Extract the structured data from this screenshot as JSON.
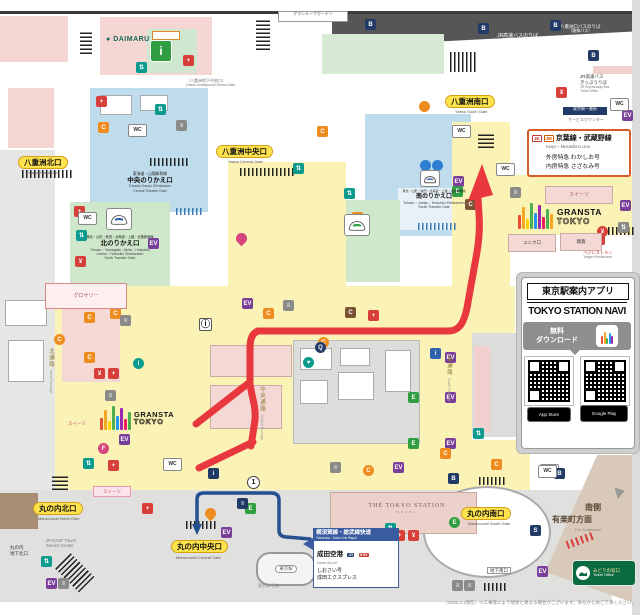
{
  "palette": {
    "route_red": "#e8383d",
    "route_navy": "#24508f",
    "concourse_yellow": "#fbf2b6",
    "shinkansen_blue": "#bedcec",
    "transfer_green": "#cfe7cb",
    "shop_pink": "#f5d6d2",
    "gray_zone": "#dcdcda",
    "dark_wall": "#565656",
    "pill_yellow": "#ffe34d",
    "keiyo_border": "#d85b2a"
  },
  "top": {
    "granroof": "グランルーフガーデン",
    "daimaru": "DAIMARU",
    "jr_bus_jp": "JR高速バスのりば",
    "jr_bus_en": "JR Expressway Bus Terminal",
    "yaesu_bus_jp": "八重洲口バスのりば",
    "yaesu_bus_sub": "（路線バス）",
    "bus_ticket_jp1": "JR高速バス",
    "bus_ticket_jp2": "きっぷうりば",
    "bus_ticket_en1": "JR Expressway Bus",
    "bus_ticket_en2": "Ticket Office",
    "ichibangai": "東京駅一番街",
    "service_counter": "サービスカウンター"
  },
  "gates": {
    "yaesu_north": {
      "jp": "八重洲北口",
      "en": "Yaesu North Gate"
    },
    "yaesu_central": {
      "jp": "八重洲中央口",
      "en": "Yaesu Central Gate"
    },
    "yaesu_south": {
      "jp": "八重洲南口",
      "en": "Yaesu South Gate"
    },
    "marunouchi_north": {
      "jp": "丸の内北口",
      "en": "Marunouchi North Gate"
    },
    "marunouchi_central": {
      "jp": "丸の内中央口",
      "en": "Marunouchi Central Gate"
    },
    "marunouchi_south": {
      "jp": "丸の内南口",
      "en": "Marunouchi South Gate"
    },
    "chika_north1": "丸の内",
    "chika_north2": "地下北口",
    "chika_south": "地下南口",
    "yaesu_chika": "（八重洲地下中央口）",
    "yaesu_chika_en": "(Yaesu Underground Central Gate)"
  },
  "transfer": {
    "central": {
      "lines": "東海道・山陽新幹線",
      "gate": "中央のりかえ口",
      "en1": "Tokaido-Sanyo Shinkansen",
      "en2": "Central Transfer Gate"
    },
    "north": {
      "lines": "東北・山形・秋田・北海道・上越・北陸新幹線",
      "gate": "北のりかえ口",
      "en1": "Tohoku・Yamagata・Akita・Hokkaido",
      "en2": "Joetsu・Hokuriku Shinkansen",
      "en3": "North Transfer Gate"
    },
    "south": {
      "lines": "東北・山形・秋田・北海道・上越・北陸新幹線",
      "gate": "南のりかえ口",
      "en1": "Tohoku・Joetsu・Hokuriku Shinkansen",
      "en2": "South Transfer Gate"
    }
  },
  "keiyo": {
    "badge1": "JE",
    "badge2": "JM",
    "title": "京葉線・武蔵野線",
    "en": "Keiyo・Musashino Line",
    "line1": "外房特急 わかしお号",
    "line2": "内房特急 さざなみ号"
  },
  "gransta": {
    "name": "GRANSTA",
    "sub": "TOKYO"
  },
  "shops": {
    "grocery": "グロサリー",
    "sweets": "スイーツ",
    "sweets2": "スイーツ",
    "sweets3": "スイーツ",
    "uniqlo": "ユニクロ",
    "zakka": "雑貨",
    "veg1": "ベジレストラン",
    "veg2": "Vegan Restaurant"
  },
  "app": {
    "title": "東京駅案内アプリ",
    "name": "TOKYO STATION NAVI",
    "free": "無料",
    "download": "ダウンロード",
    "store1": "App Store",
    "store2": "Google Play"
  },
  "marunouchi": {
    "travel1": "JR EAST Travel",
    "travel2": "Service Center",
    "station": "東京駅",
    "station_sub": "東京駅 石像",
    "hotel": "THE TOKYO STATION",
    "hotel_sub": "HOTEL",
    "yokosuka": {
      "title": "横須賀線・総武線快速",
      "en": "Yokosuka・Sobu Line Rapid",
      "dest": "成田空港",
      "dest_en": "Narita Airport",
      "t1": "しおさい号",
      "t2": "成田エクスプレス",
      "badge1": "JO",
      "badge2": "N'EX"
    },
    "south_side1": "南側",
    "south_side2": "有楽町方面",
    "south_side_en": "For Yurakucho",
    "midori1": "みどりの窓口",
    "midori2": "Ticket Office"
  },
  "passages": {
    "north": "北通路",
    "north_en": "North Passage",
    "central": "中央通路",
    "central_en": "Central Passage",
    "south": "南通路",
    "south_en": "South Passage"
  },
  "footer": "（2025.3.1現在）※工事等により現状と異なる場合がございます。あらかじめご了承ください。",
  "chips": [
    [
      "sq",
      136,
      62,
      "#0a9b8e",
      "⇅",
      "escalator-icon"
    ],
    [
      "sq",
      183,
      55,
      "#d7403a",
      "+",
      "first-aid-icon"
    ],
    [
      "sq",
      365,
      19,
      "#223a66",
      "B",
      "bus-stop-icon"
    ],
    [
      "sq",
      478,
      23,
      "#223a66",
      "B",
      "bus-stop-icon"
    ],
    [
      "sq",
      550,
      20,
      "#223a66",
      "B",
      "bus-stop-icon"
    ],
    [
      "sq",
      588,
      50,
      "#223a66",
      "B",
      "bus-stop-icon"
    ],
    [
      "sq",
      556,
      87,
      "#d7403a",
      "¥",
      "ticket-machine-icon"
    ],
    [
      "sq",
      622,
      110,
      "#7a3f98",
      "EV",
      "elevator-icon"
    ],
    [
      "wc",
      610,
      98,
      "",
      "WC",
      "restroom-icon"
    ],
    [
      "sq",
      96,
      96,
      "#d7403a",
      "+",
      "first-aid-icon"
    ],
    [
      "sq",
      98,
      122,
      "#ef8c1f",
      "C",
      "coin-locker-icon"
    ],
    [
      "wc",
      128,
      124,
      "",
      "WC",
      "restroom-icon"
    ],
    [
      "sq",
      155,
      104,
      "#0a9b8e",
      "⇅",
      "escalator-icon"
    ],
    [
      "sq",
      176,
      120,
      "#8a8a88",
      "≡",
      "stairs-icon"
    ],
    [
      "info",
      199,
      318,
      "",
      "ⓘ",
      "information-icon"
    ],
    [
      "sq",
      242,
      298,
      "#7a3f98",
      "EV",
      "elevator-icon"
    ],
    [
      "sq",
      74,
      206,
      "#d7403a",
      "+",
      "first-aid-icon"
    ],
    [
      "wc",
      78,
      212,
      "",
      "WC",
      "restroom-icon"
    ],
    [
      "sq",
      148,
      238,
      "#7a3f98",
      "EV",
      "elevator-icon"
    ],
    [
      "sq",
      75,
      256,
      "#d7403a",
      "¥",
      "ticket-machine-icon"
    ],
    [
      "sq",
      76,
      230,
      "#0a9b8e",
      "⇅",
      "escalator-icon"
    ],
    [
      "sq",
      293,
      163,
      "#0a9b8e",
      "⇅",
      "escalator-icon"
    ],
    [
      "sq",
      317,
      126,
      "#ef8c1f",
      "C",
      "coin-locker-icon"
    ],
    [
      "ci",
      419,
      101,
      "#ef8c1f",
      "",
      "meeting-point-icon"
    ],
    [
      "wc",
      452,
      125,
      "",
      "WC",
      "restroom-icon"
    ],
    [
      "sq",
      453,
      176,
      "#7a3f98",
      "EV",
      "elevator-icon"
    ],
    [
      "sq",
      344,
      188,
      "#0a9b8e",
      "⇅",
      "escalator-icon"
    ],
    [
      "sq",
      352,
      212,
      "#ef8c1f",
      "C",
      "coin-locker-icon"
    ],
    [
      "wc",
      496,
      163,
      "",
      "WC",
      "restroom-icon"
    ],
    [
      "sq",
      465,
      199,
      "#7b5335",
      "C",
      "coin-locker-icon"
    ],
    [
      "sq",
      452,
      186,
      "#2f9e41",
      "E",
      "exit-icon"
    ],
    [
      "sq",
      533,
      152,
      "#d7403a",
      "+",
      "first-aid-icon"
    ],
    [
      "sq",
      594,
      234,
      "#d7403a",
      "¥",
      "ticket-machine-icon"
    ],
    [
      "sq",
      618,
      222,
      "#8a8a88",
      "⇅",
      "escalator-icon"
    ],
    [
      "sq",
      620,
      200,
      "#7a3f98",
      "EV",
      "elevator-icon"
    ],
    [
      "ci",
      597,
      226,
      "#d7403a",
      "¥",
      "atm-icon"
    ],
    [
      "sq",
      263,
      308,
      "#ef8c1f",
      "C",
      "coin-locker-icon"
    ],
    [
      "sq",
      283,
      300,
      "#8a8a88",
      "≡",
      "stairs-icon"
    ],
    [
      "sq",
      345,
      307,
      "#7b5335",
      "C",
      "coin-locker-icon"
    ],
    [
      "sq",
      368,
      310,
      "#d7403a",
      "+",
      "first-aid-icon"
    ],
    [
      "ci",
      318,
      337,
      "#ef8c1f",
      "C",
      "coin-locker-icon"
    ],
    [
      "ci",
      303,
      357,
      "#0a9b8e",
      "♥",
      "meeting-point-icon"
    ],
    [
      "ci",
      315,
      342,
      "#223a66",
      "Q",
      "info-search-icon"
    ],
    [
      "ci",
      133,
      358,
      "#0a9b8e",
      "i",
      "information-icon"
    ],
    [
      "sq",
      84,
      312,
      "#ef8c1f",
      "C",
      "coin-locker-icon"
    ],
    [
      "sq",
      110,
      308,
      "#ef8c1f",
      "C",
      "coin-locker-icon"
    ],
    [
      "sq",
      84,
      352,
      "#ef8c1f",
      "C",
      "coin-locker-icon"
    ],
    [
      "ci",
      54,
      334,
      "#ef8c1f",
      "C",
      "coin-locker-icon"
    ],
    [
      "sq",
      94,
      368,
      "#d7403a",
      "¥",
      "ticket-machine-icon"
    ],
    [
      "sq",
      108,
      368,
      "#d7403a",
      "+",
      "first-aid-icon"
    ],
    [
      "sq",
      119,
      434,
      "#7a3f98",
      "EV",
      "elevator-icon"
    ],
    [
      "ci",
      98,
      443,
      "#d6457e",
      "F",
      "nursing-room-icon"
    ],
    [
      "sq",
      120,
      315,
      "#8a8a88",
      "≡",
      "stairs-icon"
    ],
    [
      "sq",
      105,
      390,
      "#8a8a88",
      "≡",
      "stairs-icon"
    ],
    [
      "sq",
      445,
      352,
      "#7a3f98",
      "EV",
      "elevator-icon"
    ],
    [
      "sq",
      445,
      392,
      "#7a3f98",
      "EV",
      "elevator-icon"
    ],
    [
      "sq",
      445,
      438,
      "#7a3f98",
      "EV",
      "elevator-icon"
    ],
    [
      "sq",
      408,
      392,
      "#2f9e41",
      "E",
      "exit-icon"
    ],
    [
      "sq",
      408,
      438,
      "#2f9e41",
      "E",
      "exit-icon"
    ],
    [
      "sq",
      430,
      348,
      "#2f62ad",
      "i",
      "information-icon"
    ],
    [
      "sq",
      473,
      428,
      "#0a9b8e",
      "⇅",
      "escalator-icon"
    ],
    [
      "sq",
      440,
      448,
      "#ef8c1f",
      "C",
      "coin-locker-icon"
    ],
    [
      "sq",
      448,
      473,
      "#223a66",
      "B",
      "bus-stop-icon"
    ],
    [
      "sq",
      83,
      458,
      "#0a9b8e",
      "⇅",
      "escalator-icon"
    ],
    [
      "sq",
      108,
      460,
      "#d7403a",
      "+",
      "first-aid-icon"
    ],
    [
      "wc",
      163,
      458,
      "",
      "WC",
      "restroom-icon"
    ],
    [
      "sq",
      208,
      468,
      "#223a66",
      "i",
      "information-icon"
    ],
    [
      "one",
      247,
      476,
      "",
      "1",
      "platform-number-icon"
    ],
    [
      "sq",
      330,
      462,
      "#8a8a88",
      "≡",
      "stairs-icon"
    ],
    [
      "ci",
      363,
      465,
      "#ef8c1f",
      "C",
      "coin-locker-icon"
    ],
    [
      "sq",
      393,
      462,
      "#7a3f98",
      "EV",
      "elevator-icon"
    ],
    [
      "sq",
      491,
      459,
      "#ef8c1f",
      "C",
      "coin-locker-icon"
    ],
    [
      "wc",
      540,
      464,
      "",
      "WC",
      "restroom-icon"
    ],
    [
      "sq",
      554,
      468,
      "#223a66",
      "B",
      "bus-stop-icon"
    ],
    [
      "sq",
      41,
      556,
      "#0a9b8e",
      "⇅",
      "escalator-icon"
    ],
    [
      "sq",
      46,
      578,
      "#7a3f98",
      "EV",
      "elevator-icon"
    ],
    [
      "sq",
      58,
      578,
      "#8a8a88",
      "≡",
      "stairs-icon"
    ],
    [
      "sq",
      142,
      503,
      "#d7403a",
      "+",
      "first-aid-icon"
    ],
    [
      "pin",
      205,
      508,
      "#ef8c1f",
      "",
      "map-pin-icon"
    ],
    [
      "sq",
      221,
      527,
      "#7a3f98",
      "EV",
      "elevator-icon"
    ],
    [
      "sq",
      245,
      503,
      "#2f9e41",
      "E",
      "exit-icon"
    ],
    [
      "sq",
      237,
      498,
      "#223a66",
      "≡",
      "stairs-icon"
    ],
    [
      "sq",
      385,
      523,
      "#0a9b8e",
      "⇅",
      "escalator-icon"
    ],
    [
      "sq",
      394,
      530,
      "#d7403a",
      "+",
      "first-aid-icon"
    ],
    [
      "sq",
      408,
      530,
      "#d7403a",
      "¥",
      "ticket-machine-icon"
    ],
    [
      "ci",
      449,
      517,
      "#2f9e41",
      "E",
      "exit-icon"
    ],
    [
      "sq",
      530,
      525,
      "#223a66",
      "S",
      "station-office-icon"
    ],
    [
      "sq",
      537,
      566,
      "#7a3f98",
      "EV",
      "elevator-icon"
    ],
    [
      "sq",
      452,
      580,
      "#8a8a88",
      "≡",
      "stairs-icon"
    ],
    [
      "sq",
      464,
      580,
      "#8a8a88",
      "≡",
      "stairs-icon"
    ],
    [
      "wc",
      538,
      465,
      "",
      "WC",
      "restroom-icon"
    ],
    [
      "pin",
      236,
      233,
      "#d6457e",
      "",
      "map-pin-icon"
    ],
    [
      "ci",
      420,
      160,
      "#2f7fd0",
      "",
      "platform-entry-icon"
    ],
    [
      "ci",
      432,
      160,
      "#2f7fd0",
      "",
      "platform-entry-icon"
    ],
    [
      "sq",
      510,
      187,
      "#8a8a88",
      "≡",
      "stairs-icon"
    ]
  ]
}
